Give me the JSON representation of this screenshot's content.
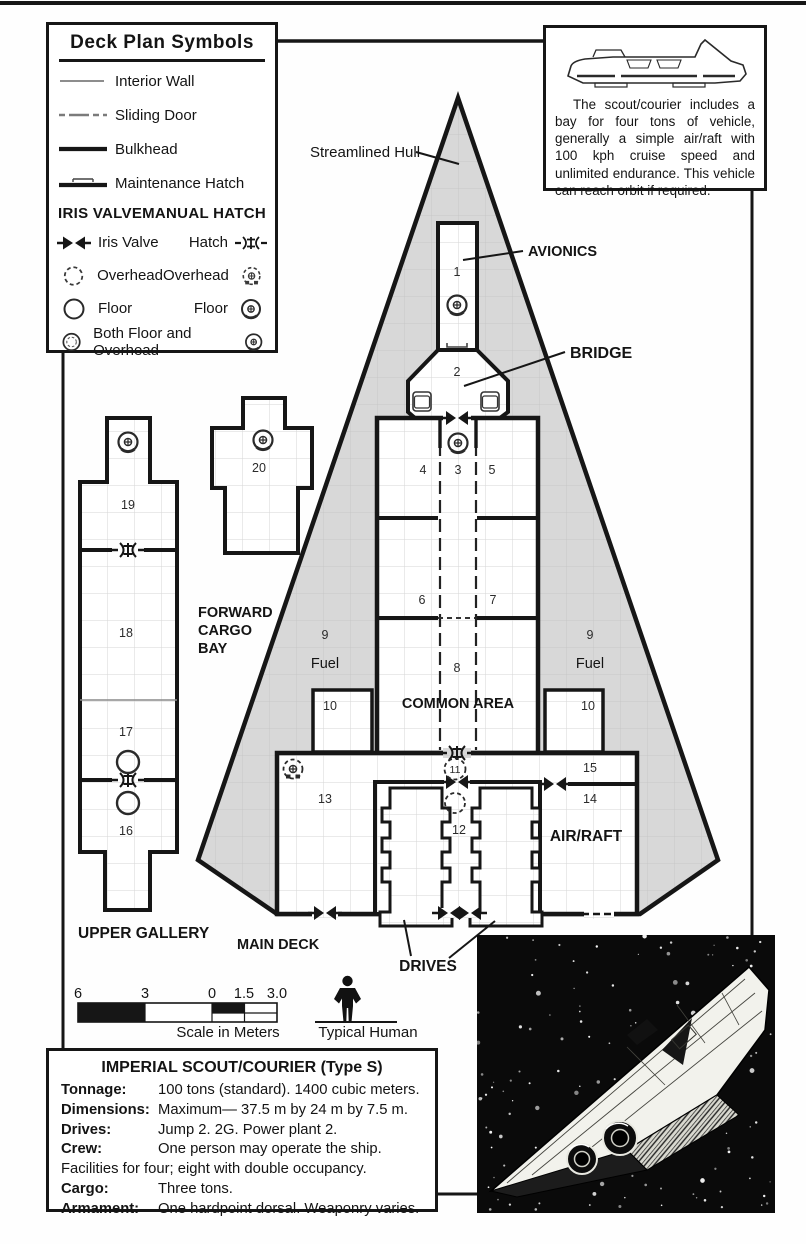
{
  "colors": {
    "ink": "#161616",
    "hull_gray": "#d8d8d8",
    "paper": "#fefefe"
  },
  "legend": {
    "title": "Deck Plan Symbols",
    "wall_items": [
      "Interior Wall",
      "Sliding Door",
      "Bulkhead",
      "Maintenance Hatch"
    ],
    "col_iris": "IRIS VALVE",
    "col_manual": "MANUAL HATCH",
    "iris_labels": [
      "Iris Valve",
      "Overhead",
      "Floor",
      "Both Floor and Overhead"
    ],
    "manual_labels": [
      "Hatch",
      "Overhead",
      "Floor"
    ]
  },
  "vehicle_note": {
    "text": "The scout/courier includes a bay for four tons of vehicle, generally a simple air/raft with 100 kph cruise speed and unlimited endurance. This vehicle can reach orbit if required."
  },
  "plan": {
    "labels": {
      "streamlined_hull": "Streamlined Hull",
      "avionics": "AVIONICS",
      "bridge": "BRIDGE",
      "forward_cargo": [
        "FORWARD",
        "CARGO",
        "BAY"
      ],
      "fuel": "Fuel",
      "common_area": "COMMON AREA",
      "air_raft": "AIR/RAFT",
      "upper_gallery": "UPPER GALLERY",
      "main_deck": "MAIN DECK",
      "drives": "DRIVES"
    },
    "room_numbers": [
      "1",
      "2",
      "3",
      "4",
      "5",
      "6",
      "7",
      "8",
      "9",
      "10",
      "11",
      "12",
      "13",
      "14",
      "15",
      "16",
      "17",
      "18",
      "19",
      "20"
    ]
  },
  "scale_bar": {
    "ticks": [
      "6",
      "3",
      "0",
      "1.5",
      "3.0"
    ],
    "caption": "Scale in Meters",
    "human_caption": "Typical Human"
  },
  "stats": {
    "title": "IMPERIAL SCOUT/COURIER (Type S)",
    "rows": [
      {
        "label": "Tonnage:",
        "value": "100 tons (standard). 1400 cubic meters."
      },
      {
        "label": "Dimensions:",
        "value": "Maximum— 37.5 m by 24 m by 7.5 m."
      },
      {
        "label": "Drives:",
        "value": "Jump 2. 2G. Power plant 2."
      },
      {
        "label": "Crew:",
        "value": "One person may operate the ship. Facilities for four; eight with double occupancy."
      },
      {
        "label": "Cargo:",
        "value": "Three tons."
      },
      {
        "label": "Armament:",
        "value": "One hardpoint dorsal. Weaponry varies."
      }
    ]
  }
}
